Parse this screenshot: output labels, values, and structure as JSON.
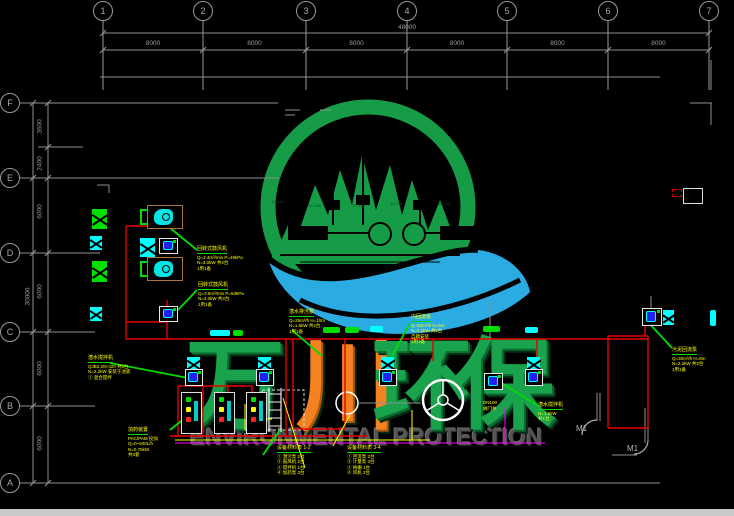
{
  "drawing": {
    "grid_top": {
      "bubbles": [
        "1",
        "2",
        "3",
        "4",
        "5",
        "6",
        "7"
      ],
      "xs": [
        103,
        203,
        306,
        407,
        507,
        608,
        709
      ],
      "overall_dim": "48000",
      "bay_dims": [
        "8000",
        "8000",
        "8000",
        "8000",
        "8000",
        "8000"
      ]
    },
    "grid_left": {
      "bubbles": [
        "F",
        "E",
        "D",
        "C",
        "B",
        "A"
      ],
      "ys": [
        103,
        178,
        253,
        332,
        406,
        483
      ],
      "overall_dim": "30000",
      "dims": [
        {
          "v": "3600",
          "y": 127
        },
        {
          "v": "2400",
          "y": 164
        },
        {
          "v": "6000",
          "y": 212
        },
        {
          "v": "6000",
          "y": 292
        },
        {
          "v": "6000",
          "y": 369
        },
        {
          "v": "6000",
          "y": 444
        }
      ]
    },
    "watermark": {
      "chars": [
        {
          "text": "万",
          "color": "#18a34c",
          "x": 185,
          "shadow": "#0b6b30"
        },
        {
          "text": "川",
          "color": "#f58220",
          "x": 296,
          "shadow": "#b35a10"
        },
        {
          "text": "环",
          "color": "#18a34c",
          "x": 372,
          "shadow": "#0b6b30"
        },
        {
          "text": "保",
          "color": "#18a34c",
          "x": 455,
          "shadow": "#0b6b30"
        }
      ],
      "char_y": 336,
      "char_size": 100,
      "subtitle": "ENVIRONMENTAL PROTECTION"
    },
    "logo_labels": [
      {
        "text": "1C-100",
        "x": 271,
        "y": 199
      },
      {
        "text": "1C-100",
        "x": 308,
        "y": 203
      },
      {
        "text": "1C-100",
        "x": 352,
        "y": 203
      },
      {
        "text": "1C-100",
        "x": 390,
        "y": 201
      },
      {
        "text": "1C-100",
        "x": 438,
        "y": 201
      }
    ],
    "door_labels": [
      {
        "text": "M1",
        "x": 576,
        "y": 424
      },
      {
        "text": "M1",
        "x": 627,
        "y": 444
      }
    ],
    "annotations": [
      {
        "x": 88,
        "y": 355,
        "title": "潜水搅拌机",
        "lines": [
          "QJB2.2/8-320 共2台",
          "N=2.2kW 安装于池底",
          "① 混合搅拌"
        ]
      },
      {
        "x": 197,
        "y": 246,
        "title": "回转式鼓风机",
        "lines": [
          "Q=2.4m³/min P=49kPa",
          "N=3.0kW 共2台",
          "1用1备"
        ]
      },
      {
        "x": 198,
        "y": 282,
        "title": "回转式鼓风机",
        "lines": [
          "Q=3.5m³/min P=53kPa",
          "N=4.0kW 共2台",
          "1用1备"
        ]
      },
      {
        "x": 289,
        "y": 309,
        "title": "潜水排污泵",
        "lines": [
          "Q=25m³/h H=10m",
          "N=1.5kW 共2台",
          "1用1备"
        ]
      },
      {
        "x": 411,
        "y": 314,
        "title": "内回流泵",
        "lines": [
          "Q=50m³/h H=5m",
          "N=2.2kW 共2台",
          "自耦安装",
          "1用1备"
        ]
      },
      {
        "x": 672,
        "y": 347,
        "title": "污泥回流泵",
        "lines": [
          "Q=30m³/h H=8m",
          "N=2.2kW 共2台",
          "1用1备"
        ]
      },
      {
        "x": 538,
        "y": 402,
        "title": "潜水搅拌机",
        "lines": [
          "N=1.5kW",
          "共1台"
        ]
      },
      {
        "x": 128,
        "y": 427,
        "title": "加药装置",
        "lines": [
          "PAC/PAM 投加",
          "Q=0~500L/h",
          "N=0.75kW",
          "共3套"
        ]
      },
      {
        "x": 277,
        "y": 445,
        "title": "设备材料表 1-2",
        "lines": [
          "① 潜污泵 2台",
          "② 鼓风机 2台",
          "③ 搅拌机 1台",
          "④ 加药泵 3台"
        ]
      },
      {
        "x": 347,
        "y": 445,
        "title": "设备材料表 3-4",
        "lines": [
          "① 回流泵 2台",
          "② 计量泵 3台",
          "③ 格栅 1台",
          "④ 风机 2台"
        ]
      },
      {
        "x": 483,
        "y": 400,
        "title": "",
        "lines": [
          "DN100",
          "阀门井"
        ]
      }
    ],
    "lines": {
      "gray": [
        [
          103,
          33,
          709,
          33
        ],
        [
          103,
          50,
          709,
          50
        ],
        [
          100,
          77,
          660,
          77
        ],
        [
          20,
          103,
          278,
          103
        ],
        [
          20,
          178,
          278,
          178
        ],
        [
          20,
          253,
          100,
          253
        ],
        [
          20,
          332,
          95,
          332
        ],
        [
          20,
          406,
          95,
          406
        ],
        [
          20,
          483,
          660,
          483
        ],
        [
          33,
          103,
          33,
          483
        ],
        [
          48,
          103,
          48,
          483
        ],
        [
          38,
          147,
          83,
          147
        ],
        [
          711,
          60,
          711,
          90
        ],
        [
          690,
          103,
          712,
          103
        ],
        [
          711,
          103,
          711,
          125
        ],
        [
          97,
          185,
          109,
          185
        ],
        [
          109,
          185,
          109,
          193
        ],
        [
          597,
          393,
          597,
          421
        ],
        [
          600,
          393,
          600,
          421
        ],
        [
          645,
          408,
          645,
          443
        ],
        [
          648,
          408,
          648,
          443
        ],
        [
          612,
          455,
          637,
          455
        ],
        [
          358,
          403,
          421,
          403
        ],
        [
          490,
          300,
          490,
          341
        ],
        [
          651,
          296,
          651,
          308
        ],
        [
          285,
          110,
          300,
          110
        ],
        [
          285,
          115,
          295,
          115
        ],
        [
          320,
          110,
          332,
          110
        ]
      ],
      "red": [
        [
          126,
          226,
          126,
          339
        ],
        [
          126,
          226,
          150,
          226
        ],
        [
          167,
          300,
          167,
          339
        ],
        [
          126,
          322,
          167,
          322
        ],
        [
          126,
          339,
          648,
          339
        ],
        [
          293,
          339,
          293,
          429
        ],
        [
          345,
          339,
          345,
          429
        ],
        [
          293,
          429,
          345,
          429
        ],
        [
          608,
          336,
          608,
          428
        ],
        [
          648,
          336,
          648,
          428
        ],
        [
          608,
          428,
          648,
          428
        ],
        [
          608,
          336,
          648,
          336
        ],
        [
          645,
          312,
          645,
          336
        ],
        [
          537,
          339,
          537,
          368
        ],
        [
          433,
          339,
          433,
          361
        ],
        [
          178,
          386,
          252,
          386
        ],
        [
          178,
          386,
          178,
          436
        ],
        [
          252,
          386,
          252,
          436
        ],
        [
          203,
          386,
          203,
          436
        ],
        [
          228,
          386,
          228,
          436
        ],
        [
          170,
          436,
          368,
          436
        ],
        [
          286,
          339,
          286,
          436
        ]
      ],
      "magenta": [
        [
          175,
          443,
          545,
          443
        ],
        [
          505,
          407,
          505,
          443
        ]
      ],
      "yellow": [
        [
          175,
          440,
          430,
          440
        ],
        [
          245,
          404,
          245,
          430
        ],
        [
          245,
          430,
          262,
          430
        ],
        [
          248,
          419,
          272,
          419
        ],
        [
          412,
          410,
          412,
          440
        ],
        [
          283,
          398,
          305,
          468
        ],
        [
          350,
          415,
          333,
          446
        ]
      ],
      "green_leaders": [
        [
          110,
          363,
          188,
          378
        ],
        [
          170,
          228,
          197,
          250
        ],
        [
          178,
          310,
          197,
          290
        ],
        [
          292,
          330,
          322,
          356
        ],
        [
          410,
          323,
          392,
          356
        ],
        [
          648,
          322,
          672,
          348
        ],
        [
          500,
          382,
          538,
          406
        ],
        [
          170,
          430,
          190,
          414
        ],
        [
          280,
          430,
          263,
          455
        ]
      ]
    },
    "bars": [
      [
        210,
        330,
        20,
        6,
        "#00ffff"
      ],
      [
        233,
        330,
        10,
        6,
        "#00dd00"
      ],
      [
        323,
        327,
        17,
        6,
        "#00dd00"
      ],
      [
        345,
        327,
        14,
        6,
        "#00dd00"
      ],
      [
        370,
        326,
        13,
        6,
        "#00ffff"
      ],
      [
        483,
        326,
        17,
        6,
        "#00dd00"
      ],
      [
        525,
        327,
        13,
        6,
        "#00ffff"
      ],
      [
        710,
        310,
        6,
        16,
        "#00ffff"
      ]
    ],
    "symbols": {
      "green_x": [
        [
          92,
          209,
          15,
          20
        ],
        [
          92,
          261,
          15,
          21
        ]
      ],
      "cyan_x": [
        [
          140,
          238,
          15,
          19
        ],
        [
          187,
          357,
          13,
          13
        ],
        [
          258,
          357,
          13,
          13
        ],
        [
          381,
          357,
          13,
          13
        ],
        [
          527,
          357,
          13,
          13
        ],
        [
          663,
          310,
          11,
          15
        ],
        [
          687,
          191,
          12,
          12
        ]
      ],
      "cyan_x_small": [
        [
          90,
          236,
          12,
          14
        ],
        [
          90,
          307,
          12,
          14
        ]
      ],
      "motor_box": [
        [
          159,
          238,
          19,
          16
        ],
        [
          159,
          306,
          19,
          16
        ],
        [
          185,
          369,
          18,
          17
        ],
        [
          256,
          369,
          18,
          17
        ],
        [
          379,
          369,
          18,
          17
        ],
        [
          525,
          369,
          18,
          17
        ],
        [
          642,
          308,
          20,
          18
        ],
        [
          484,
          373,
          19,
          17
        ]
      ],
      "tan_unit": [
        [
          147,
          205,
          36,
          24
        ],
        [
          147,
          257,
          36,
          24
        ]
      ],
      "bracket": [
        [
          140,
          209,
          7,
          16
        ],
        [
          140,
          261,
          7,
          16
        ]
      ],
      "dosing_unit": [
        [
          181,
          392,
          21,
          42
        ],
        [
          214,
          392,
          21,
          42
        ],
        [
          246,
          392,
          21,
          42
        ]
      ],
      "white_box": [
        [
          683,
          188,
          20,
          16
        ]
      ],
      "red_dash": [
        [
          672,
          189,
          10,
          8
        ]
      ]
    },
    "colors": {
      "background": "#000000",
      "grid": "#9a9a9a",
      "pipe_red": "#e80000",
      "magenta": "#ff00ff",
      "annotation_yellow": "#ffff00",
      "leader_green": "#00dd00",
      "logo_green": "#169c46",
      "logo_blue": "#2aabe2",
      "char_orange": "#f58220",
      "equipment_cyan": "#00ffff",
      "equipment_blue": "#2222ee",
      "unit_tan": "#a87840"
    }
  }
}
